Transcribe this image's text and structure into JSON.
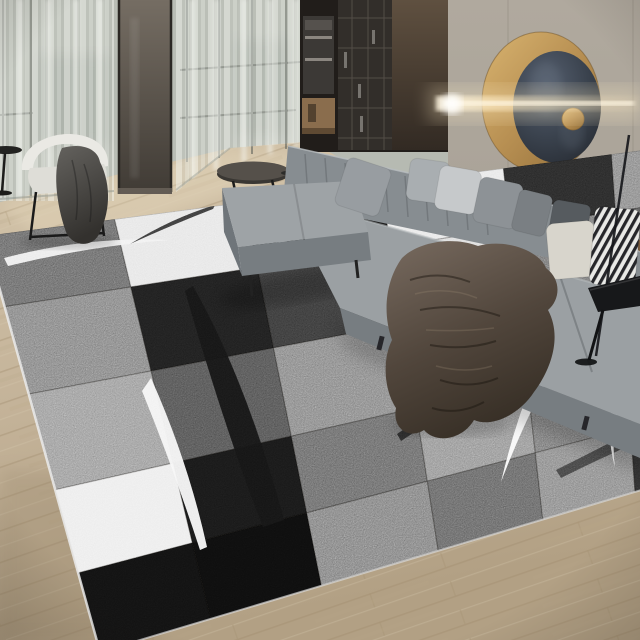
{
  "scene": {
    "label": "modern living room photo featuring a geometric patchwork area rug",
    "objects": [
      "sheer-curtains",
      "glass-door",
      "built-in-cabinets",
      "wall-panel",
      "round-brass-wall-art",
      "light-beam-sconce",
      "gray-sectional-sofa",
      "throw-pillows",
      "fur-throw-blanket",
      "cream-accent-chair",
      "oval-side-table",
      "black-pedestal-table",
      "round-black-side-table",
      "floor-lamp-pole",
      "wood-floor",
      "patchwork-rug"
    ]
  },
  "palette": {
    "wood": "#cbbba1",
    "wood-mid": "#bfae93",
    "wood-dark": "#ac9a7e",
    "wood-seam": "#9f8b6b",
    "wood-hi": "#e2d5ba",
    "wall": "#aba49a",
    "wall-hi": "#b7b0a5",
    "wall-seam": "#8f887d",
    "curtain": "#b9bdb5",
    "sheer-light": "#f2f4ef",
    "sheer-mid": "#e2e5df",
    "sheer-dark": "#c2c6bf",
    "mullion": "#585c56",
    "door-top": "#756d63",
    "door-bottom": "#403b35",
    "cabinet": "#211d1a",
    "cabinet-glass": "#322e2a",
    "glass-line": "#6e685f",
    "shelf-wood": "#8a6d4d",
    "panel-light": "#5f5040",
    "panel-dark": "#322a23",
    "brass-hi": "#d9b470",
    "brass": "#b78f52",
    "brass-dark": "#8f6c38",
    "disc-light": "#505a66",
    "disc-dark": "#262b32",
    "beam": "#fff6e2",
    "sofa-top": "#9ba0a3",
    "sofa-front": "#777d81",
    "sofa-back": "#878d91",
    "sofa-hi": "#b6babd",
    "sofa-side": "#6f757a",
    "chaise-top": "#9ea3a6",
    "pillow-a": "#989da1",
    "pillow-b": "#a9aeb1",
    "pillow-c": "#c6c9cb",
    "pillow-d": "#8d9296",
    "pillow-e": "#7a7f83",
    "pillow-f": "#565b5f",
    "pillow-cream": "#d8d5cc",
    "stripe-dark": "#26262a",
    "stripe-light": "#e9e9e6",
    "fur-light": "#73665b",
    "fur-dark": "#3a3129",
    "chair": "#eae9e4",
    "chair-seat": "#deddd7",
    "throw-light": "#64625e",
    "throw-dark": "#363431",
    "black-matte": "#17181a",
    "stool-brown": "#7a5634"
  },
  "rug": {
    "quad": {
      "tl": [
        -15,
        236
      ],
      "tr": [
        705,
        142
      ],
      "br": [
        715,
        468
      ],
      "bl": [
        100,
        652
      ]
    },
    "cols_u": [
      0,
      0.18,
      0.36,
      0.55,
      0.72,
      0.87,
      1
    ],
    "rows_v": [
      0,
      0.17,
      0.38,
      0.61,
      0.81,
      1
    ],
    "tiles": [
      [
        "#6f6f6f",
        "#e7e7e7",
        "#1b1b1b",
        "#e9e9e9",
        "#2b2b2b",
        "#8f8f8f"
      ],
      [
        "#8a8a8a",
        "#202020",
        "#3d3d3d",
        "#dedede",
        "#7b7b7b",
        "#616161"
      ],
      [
        "#a0a0a0",
        "#585858",
        "#8d8d8d",
        "#7a7a7a",
        "#262626",
        "#454545"
      ],
      [
        "#ededed",
        "#191919",
        "#6f6f6f",
        "#9a9a9a",
        "#808080",
        "#8e8e8e"
      ],
      [
        "#121212",
        "#0e0e0e",
        "#878787",
        "#6b6b6b",
        "#909090",
        "#2f2f2f"
      ]
    ],
    "seam_color": "rgba(0,0,0,0.24)",
    "edge_left": "#ececec",
    "edge_near": "#d9d9d9",
    "swooshes": [
      {
        "name": "white-arc-far-left",
        "d": "M 4,258 Q 88,236 170,240 Q 90,246 8,266 Z",
        "fill": "#f1f1f1",
        "opacity": 0.95
      },
      {
        "name": "black-arc-white-tile",
        "d": "M 215,205 Q 172,218 130,244 Q 174,224 213,209 Z",
        "fill": "#2a2a2a",
        "opacity": 0.9
      },
      {
        "name": "black-arc-under-chaise",
        "d": "M 316,227 Q 344,237 368,247 Q 341,242 314,231 Z",
        "fill": "#333333",
        "opacity": 0.85
      },
      {
        "name": "big-black-swoosh",
        "d": "M 193,286 Q 247,382 284,520 L 263,527 Q 225,430 185,291 Z",
        "fill": "#161616",
        "opacity": 0.97
      },
      {
        "name": "white-crescent-left",
        "d": "M 151,378 Q 188,461 207,547 L 200,550 Q 173,467 142,391 Z",
        "fill": "#f7f7f7",
        "opacity": 0.95
      },
      {
        "name": "white-sliver-center",
        "d": "M 290,238 Q 276,251 263,267 Q 271,249 285,235 Z",
        "fill": "#f4f4f4",
        "opacity": 0.9
      },
      {
        "name": "white-swoosh-mid",
        "d": "M 452,249 Q 436,276 421,308 Q 429,272 441,247 Z",
        "fill": "#f6f6f6",
        "opacity": 0.92
      },
      {
        "name": "dark-band-right-corner",
        "d": "M 556,470 Q 600,448 640,427 L 640,441 Q 599,459 561,478 Z",
        "fill": "#3b3b3b",
        "opacity": 0.85
      },
      {
        "name": "big-white-swoosh-right",
        "d": "M 585,320 Q 540,380 501,482 Q 525,380 566,315 Z",
        "fill": "#fbfbfb",
        "opacity": 0.96
      },
      {
        "name": "black-arc-right",
        "d": "M 397,434 Q 452,396 510,375 Q 455,405 401,441 Z",
        "fill": "#242424",
        "opacity": 0.9
      },
      {
        "name": "white-arc-far-right",
        "d": "M 636,370 Q 608,414 615,468 Q 600,412 628,366 Z",
        "fill": "#f8f8f8",
        "opacity": 0.93
      }
    ]
  }
}
